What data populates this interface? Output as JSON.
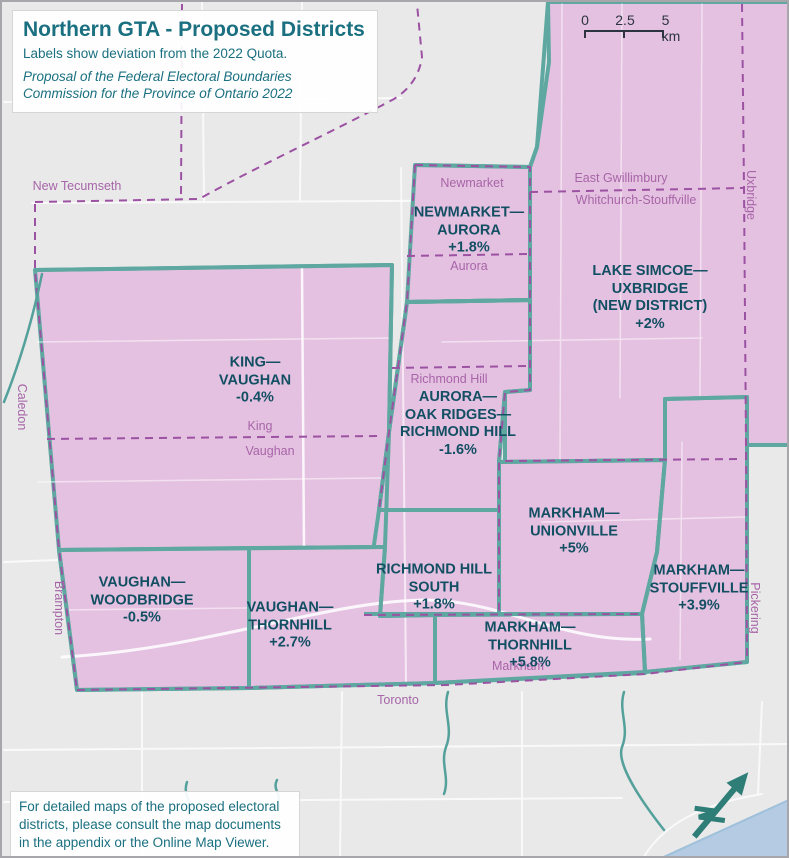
{
  "title_box": {
    "title": "Northern GTA - Proposed Districts",
    "subtitle": "Labels show deviation from the 2022 Quota.",
    "attribution": "Proposal of the Federal Electoral Boundaries Commission for the Province of Ontario 2022"
  },
  "scale_bar": {
    "start": "0",
    "mid": "2.5",
    "end": "5 km"
  },
  "districts": [
    {
      "name": "NEWMARKET—\nAURORA",
      "deviation": "+1.8%"
    },
    {
      "name": "LAKE SIMCOE—\nUXBRIDGE\n(NEW DISTRICT)",
      "deviation": "+2%"
    },
    {
      "name": "KING—\nVAUGHAN",
      "deviation": "-0.4%"
    },
    {
      "name": "AURORA—\nOAK RIDGES—\nRICHMOND HILL",
      "deviation": "-1.6%"
    },
    {
      "name": "MARKHAM—\nUNIONVILLE",
      "deviation": "+5%"
    },
    {
      "name": "RICHMOND HILL\nSOUTH",
      "deviation": "+1.8%"
    },
    {
      "name": "MARKHAM—\nSTOUFFVILLE",
      "deviation": "+3.9%"
    },
    {
      "name": "VAUGHAN—\nWOODBRIDGE",
      "deviation": "-0.5%"
    },
    {
      "name": "VAUGHAN—\nTHORNHILL",
      "deviation": "+2.7%"
    },
    {
      "name": "MARKHAM—\nTHORNHILL",
      "deviation": "+5.8%"
    }
  ],
  "places": [
    {
      "label": "New Tecumseth"
    },
    {
      "label": "Caledon"
    },
    {
      "label": "Brampton"
    },
    {
      "label": "Newmarket"
    },
    {
      "label": "Aurora"
    },
    {
      "label": "Richmond Hill"
    },
    {
      "label": "King"
    },
    {
      "label": "Vaughan"
    },
    {
      "label": "East Gwillimbury"
    },
    {
      "label": "Whitchurch-Stouffville"
    },
    {
      "label": "Uxbridge"
    },
    {
      "label": "Pickering"
    },
    {
      "label": "Markham"
    },
    {
      "label": "Toronto"
    }
  ],
  "footer_box": {
    "text": "For detailed maps of the proposed electoral districts, please consult the map documents in the appendix or the Online Map Viewer."
  },
  "colors": {
    "district_fill": "#e5c1e1",
    "district_border": "#5fa8a1",
    "municipal_boundary": "#9c52a2",
    "district_label_text": "#134f63",
    "place_label_text": "#a765a8",
    "panel_text": "#1a7080",
    "water": "#b5cbe4",
    "background": "#e9e9ea"
  }
}
